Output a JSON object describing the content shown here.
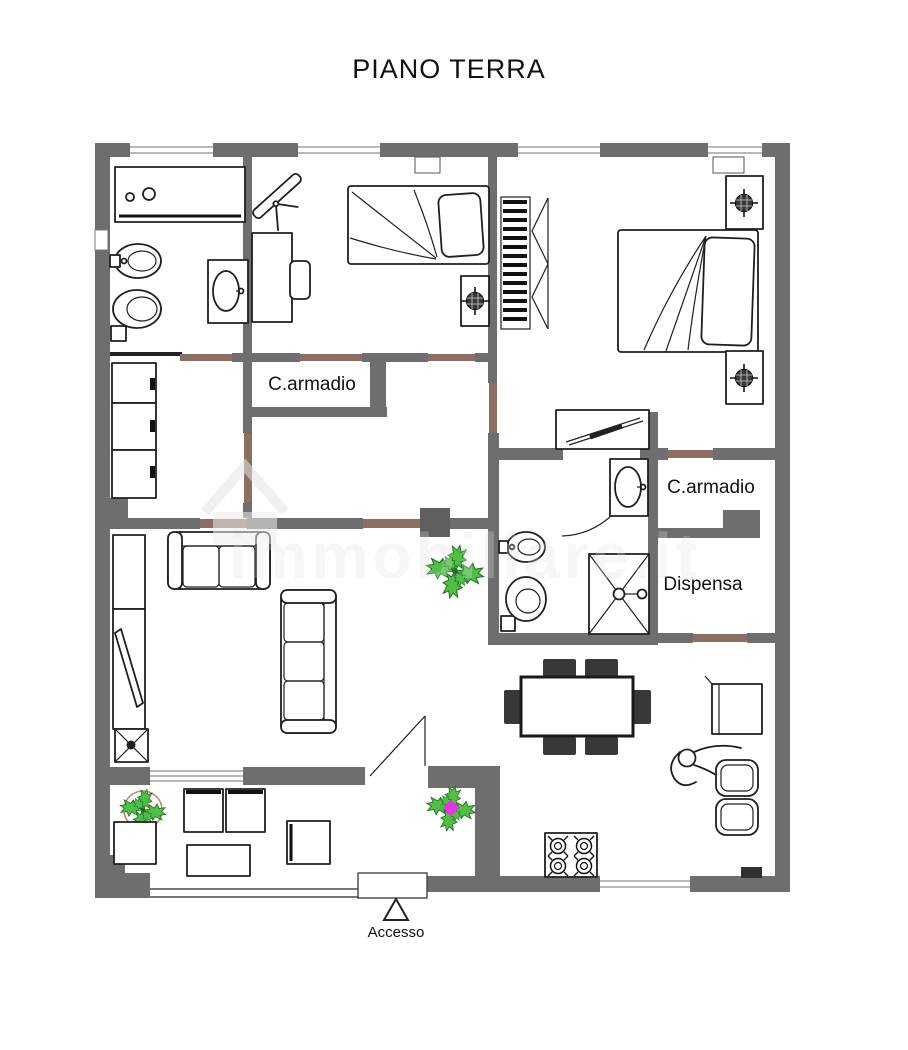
{
  "title": "PIANO TERRA",
  "watermark": "immobiliare.it",
  "labels": {
    "closet_left": "C.armadio",
    "closet_right": "C.armadio",
    "pantry": "Dispensa",
    "entrance": "Accesso"
  },
  "floor_plan": {
    "rooms": [
      {
        "id": "bathroom-main",
        "furniture": [
          "bathtub",
          "bidet",
          "toilet",
          "sink-vanity"
        ]
      },
      {
        "id": "bedroom-single",
        "furniture": [
          "single-bed",
          "nightstand-lamp",
          "desk",
          "chair",
          "drawing-board"
        ]
      },
      {
        "id": "bedroom-double",
        "furniture": [
          "double-bed",
          "nightstand-lamp",
          "nightstand-lamp",
          "open-wardrobe-hangers",
          "radiator-shelf"
        ]
      },
      {
        "id": "walk-in-closet-left",
        "label": "C.armadio"
      },
      {
        "id": "walk-in-closet-right",
        "label": "C.armadio"
      },
      {
        "id": "pantry",
        "label": "Dispensa"
      },
      {
        "id": "bathroom-ensuite",
        "furniture": [
          "bidet",
          "toilet",
          "sink-vanity",
          "shower"
        ]
      },
      {
        "id": "storage-room",
        "furniture": [
          "wardrobe-cabinets"
        ]
      },
      {
        "id": "living-room",
        "furniture": [
          "sofa-2-seat",
          "sofa-3-seat",
          "tv-cabinet",
          "wall-cabinet"
        ]
      },
      {
        "id": "kitchen-dining",
        "furniture": [
          "dining-table",
          "six-chairs",
          "stove-4-burners",
          "double-sink",
          "counter",
          "person-figure"
        ]
      },
      {
        "id": "terrace",
        "furniture": [
          "armchair",
          "armchair",
          "bench-2-seat",
          "coffee-table",
          "potted-plant"
        ]
      }
    ],
    "plants": 3,
    "entrance_marker": "triangle"
  },
  "colors": {
    "wall_gray": "#6e6e6e",
    "door_accent_brown": "#8d6e63",
    "line_black": "#1f1f1f",
    "plant_green": "#4fbf46",
    "accent_magenta": "#e236e2",
    "pot_brown": "#bb8d6f",
    "watermark_gray": "#dedede"
  }
}
